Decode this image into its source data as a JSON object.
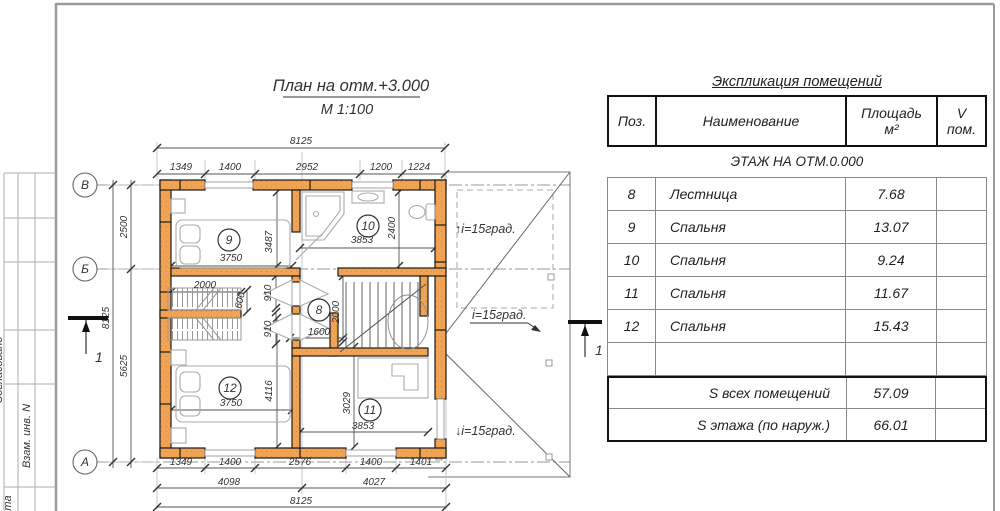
{
  "sheet": {
    "stamp": {
      "c1": "Согласовано",
      "c2": "Взам. инв. N",
      "c3": "та"
    }
  },
  "plan": {
    "title": {
      "main": "План на отм.+3.000",
      "scale": "М 1:100"
    },
    "grid": {
      "v": "В",
      "b": "Б",
      "a": "А"
    },
    "sections": {
      "left": "1",
      "right": "1"
    },
    "rooms": {
      "r8": "8",
      "r9": "9",
      "r10": "10",
      "r11": "11",
      "r12": "12"
    },
    "slopes": {
      "up": "↑i=15град.",
      "right": "i=15град.",
      "down": "↓i=15град."
    },
    "dims": {
      "top_total": "8125",
      "top1": "1349",
      "top2": "1400",
      "top3": "2952",
      "top4": "1200",
      "top5": "1224",
      "left_total": "8125",
      "left1": "2500",
      "left2": "5625",
      "bot1": "1349",
      "bot2": "1400",
      "bot3": "2576",
      "bot4": "1400",
      "bot5": "1401",
      "bot_mid1": "4098",
      "bot_mid2": "4027",
      "bot_total": "8125",
      "r9_w": "3750",
      "r9_h": "3487",
      "r10_w": "3853",
      "r10_h": "2400",
      "cl_w": "2000",
      "cl_d": "600",
      "d1": "910",
      "d2": "910",
      "r8_h": "2000",
      "r8_w": "1600",
      "r12_w": "3750",
      "r12_h": "4116",
      "r11_w": "3853",
      "r11_h": "3029"
    }
  },
  "table": {
    "caption": "Экспликация помещений",
    "header": {
      "pos": "Поз.",
      "name": "Наименование",
      "area1": "Площадь",
      "area2": "м²",
      "v1": "V",
      "v2": "пом."
    },
    "section": "ЭТАЖ НА ОТМ.0.000",
    "rows": [
      {
        "pos": "8",
        "name": "Лестница",
        "area": "7.68",
        "v": ""
      },
      {
        "pos": "9",
        "name": "Спальня",
        "area": "13.07",
        "v": ""
      },
      {
        "pos": "10",
        "name": "Спальня",
        "area": "9.24",
        "v": ""
      },
      {
        "pos": "11",
        "name": "Спальня",
        "area": "11.67",
        "v": ""
      },
      {
        "pos": "12",
        "name": "Спальня",
        "area": "15.43",
        "v": ""
      }
    ],
    "totals": [
      {
        "label": "S всех помещений",
        "value": "57.09"
      },
      {
        "label": "S этажа (по наруж.)",
        "value": "66.01"
      }
    ]
  }
}
